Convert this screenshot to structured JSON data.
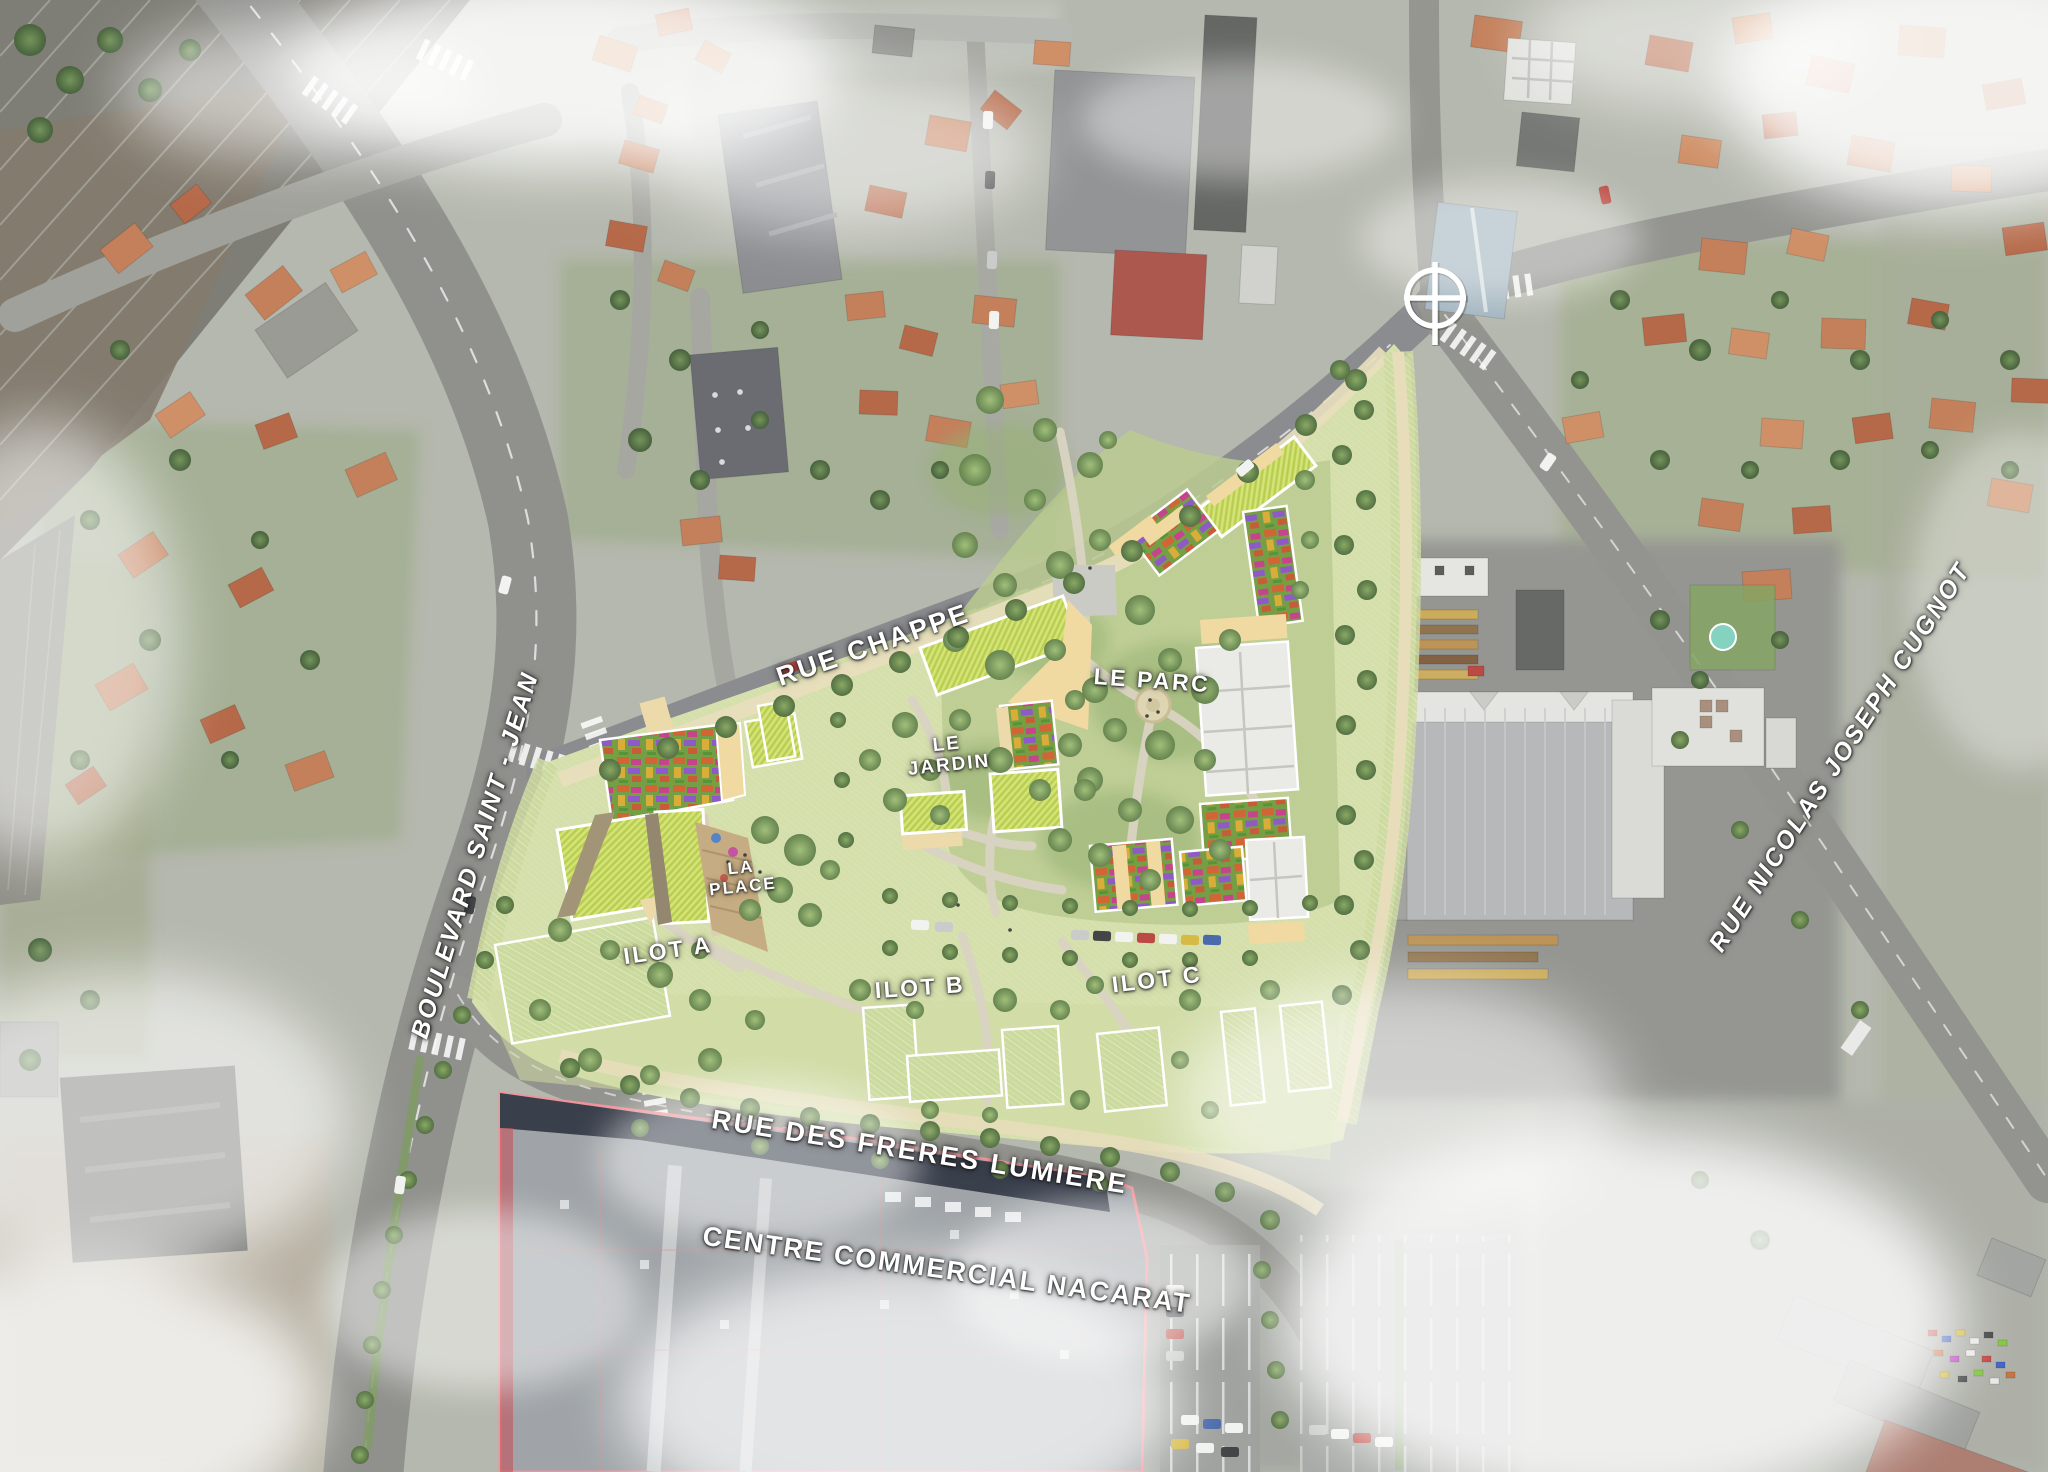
{
  "labels": {
    "rue_chappe": "RUE CHAPPE",
    "boulevard_saint_jean": "BOULEVARD SAINT - JEAN",
    "rue_des_freres_lumiere": "RUE DES FRERES LUMIERE",
    "rue_nicolas_joseph_cugnot": "RUE NICOLAS JOSEPH CUGNOT",
    "centre_commercial_nacarat": "CENTRE COMMERCIAL NACARAT",
    "le_parc": "LE PARC",
    "le_jardin_line1": "LE",
    "le_jardin_line2": "JARDIN",
    "la_place_line1": "LA",
    "la_place_line2": "PLACE",
    "ilot_a": "ILOT A",
    "ilot_b": "ILOT B",
    "ilot_c": "ILOT C"
  },
  "icons": {
    "north_compass": "crosshair-circle-icon"
  },
  "colors": {
    "site_lawn": "#d6e0ac",
    "green_roof": "#b5cc47",
    "courtyard_tan": "#f0d89e",
    "garden_base": "#6f9a3c",
    "park_tree": "#5e7e47",
    "road_gray": "#8b8c87",
    "roof_orange": "#c07a52",
    "commercial_roof": "#9ba0a4",
    "commercial_outline": "#ef8f96",
    "railway": "#78776f",
    "cloud": "#ffffff",
    "label_text": "#ffffff"
  }
}
